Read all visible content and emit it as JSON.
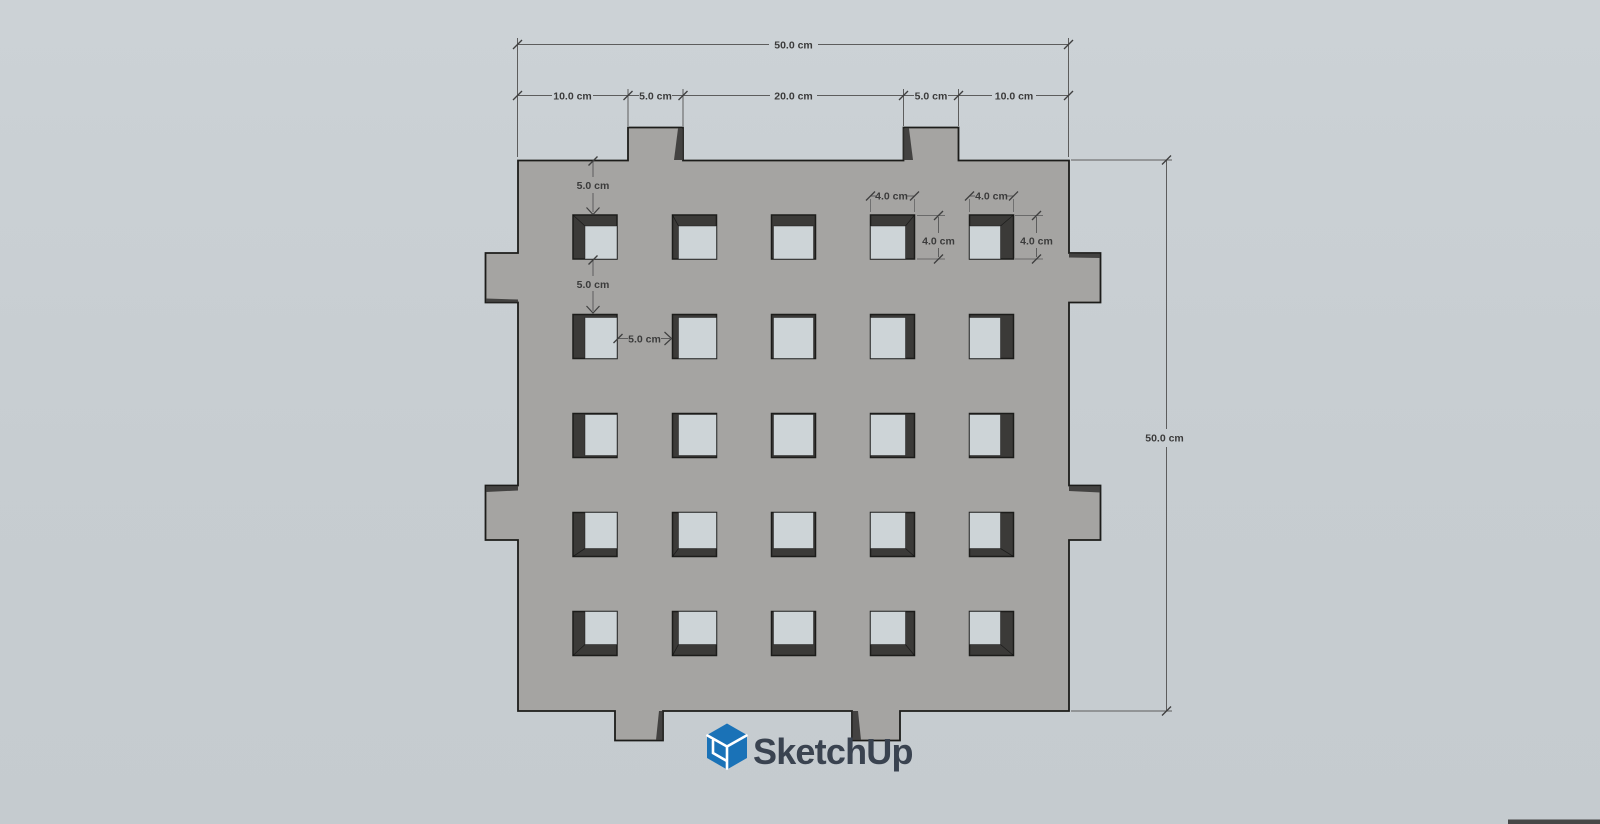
{
  "viewport": {
    "background_top": "#ccd2d6",
    "background_bottom": "#c5cbcf"
  },
  "model": {
    "plate_color": "#a5a4a2",
    "hole_interior_color": "#cdd4d7",
    "hole_wall_color": "#3b3a38",
    "outline_color": "#1c1c1a"
  },
  "dimensions": {
    "line_color": "#5d5d5d",
    "text_color": "#3b3b3b",
    "top_total": "50.0 cm",
    "top_segments": [
      "10.0 cm",
      "5.0 cm",
      "20.0 cm",
      "5.0 cm",
      "10.0 cm"
    ],
    "right_total": "50.0 cm",
    "top_edge_offset": "5.0 cm",
    "row_gap": "5.0 cm",
    "col_gap": "5.0 cm",
    "hole4_width": "4.0 cm",
    "hole5_width": "4.0 cm",
    "hole4_height": "4.0 cm",
    "hole5_height": "4.0 cm"
  },
  "watermark": {
    "name": "SketchUp",
    "icon_color": "#1a72b7",
    "text_color": "#3a4350"
  },
  "taskbar_sliver": {
    "color": "#474747"
  }
}
